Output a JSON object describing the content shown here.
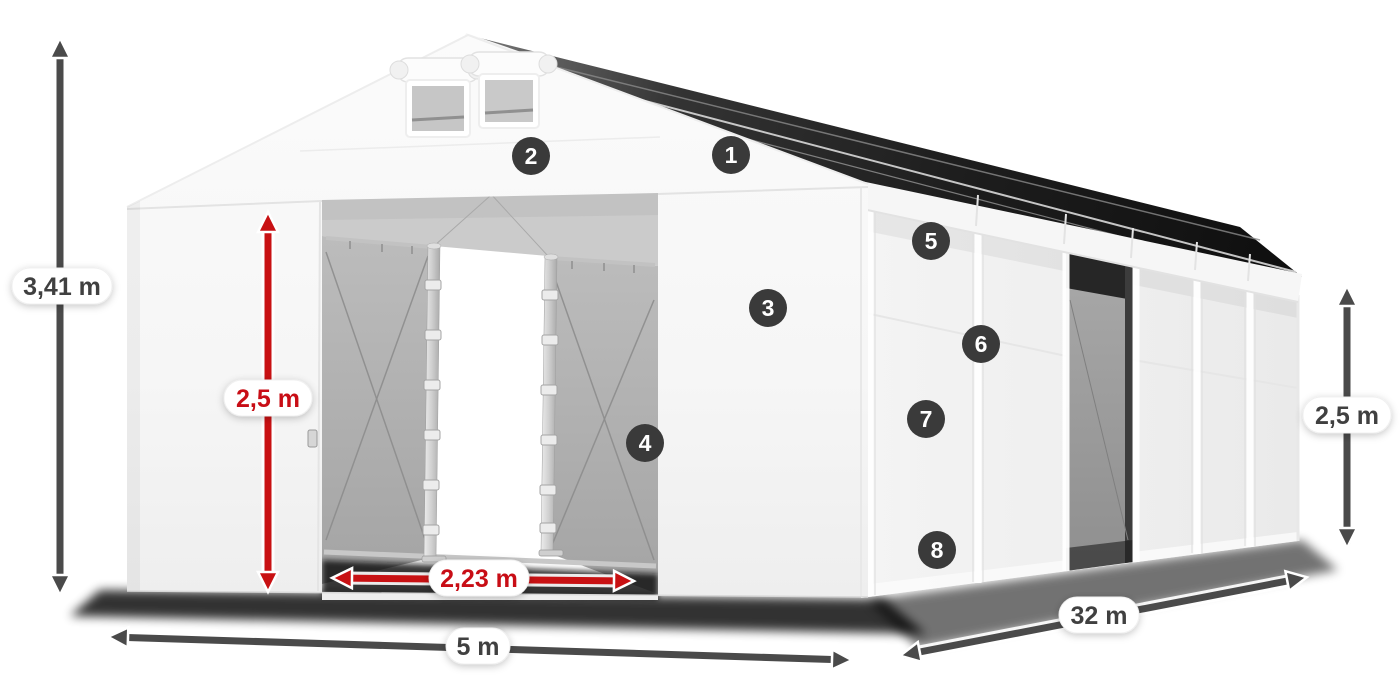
{
  "page": {
    "background": "#ffffff"
  },
  "diagram": {
    "kind": "tent-dimension-diagram",
    "dimensions": {
      "total_height": {
        "value": "3,41 m",
        "style": "dark",
        "orientation": "vertical"
      },
      "door_height": {
        "value": "2,5 m",
        "style": "red",
        "orientation": "vertical"
      },
      "door_width": {
        "value": "2,23 m",
        "style": "red",
        "orientation": "horizontal"
      },
      "width": {
        "value": "5 m",
        "style": "dark",
        "orientation": "horizontal"
      },
      "length": {
        "value": "32 m",
        "style": "dark",
        "orientation": "diagonal"
      },
      "side_height": {
        "value": "2,5 m",
        "style": "dark",
        "orientation": "vertical"
      }
    },
    "markers": [
      {
        "number": "1"
      },
      {
        "number": "2"
      },
      {
        "number": "3"
      },
      {
        "number": "4"
      },
      {
        "number": "5"
      },
      {
        "number": "6"
      },
      {
        "number": "7"
      },
      {
        "number": "8"
      }
    ],
    "colors": {
      "dimension_dark": "#4a4a4a",
      "dimension_red": "#c81113",
      "pill_background": "#ffffff",
      "pill_text_dark": "#3f3f3f",
      "marker_background": "#3a3a3a",
      "marker_text": "#ffffff",
      "tent_white": "#f5f5f5",
      "interior_gray": "#b3b3b3",
      "roof_shadow_dark": "#1d1d1d"
    }
  }
}
